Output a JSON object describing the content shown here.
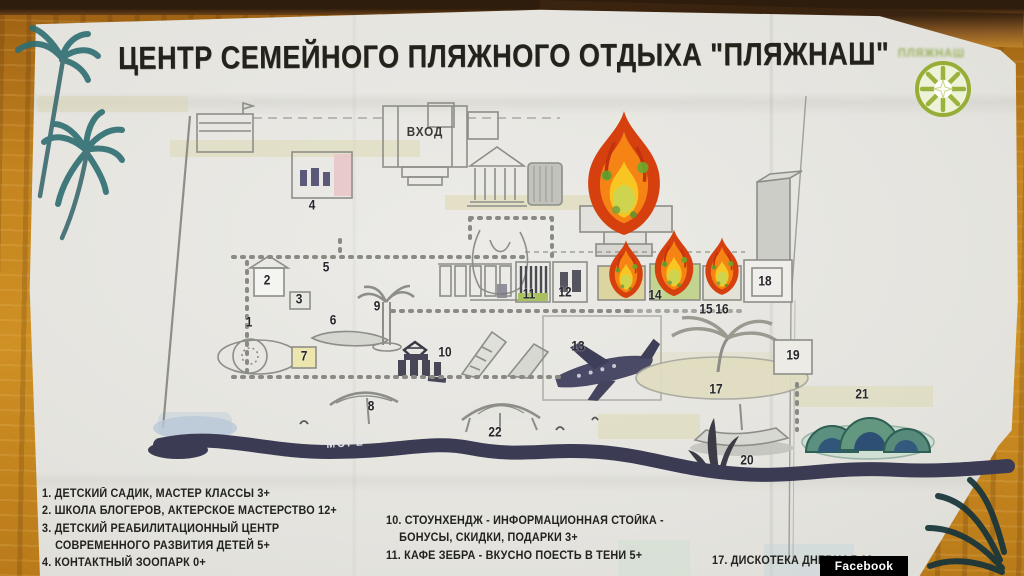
{
  "title": "ЦЕНТР СЕМЕЙНОГО ПЛЯЖНОГО ОТДЫХА \"ПЛЯЖНАШ\"",
  "logo": {
    "text": "ПЛЯЖНАШ"
  },
  "map": {
    "entrance_label": "ВХОД",
    "sea_label": "МОРЕ",
    "markers": [
      {
        "n": "1",
        "x": 249,
        "y": 322
      },
      {
        "n": "2",
        "x": 267,
        "y": 280
      },
      {
        "n": "3",
        "x": 299,
        "y": 299
      },
      {
        "n": "4",
        "x": 312,
        "y": 205
      },
      {
        "n": "5",
        "x": 326,
        "y": 267
      },
      {
        "n": "6",
        "x": 333,
        "y": 320
      },
      {
        "n": "7",
        "x": 304,
        "y": 356
      },
      {
        "n": "8",
        "x": 371,
        "y": 406
      },
      {
        "n": "9",
        "x": 377,
        "y": 306
      },
      {
        "n": "10",
        "x": 445,
        "y": 352
      },
      {
        "n": "11",
        "x": 529,
        "y": 294
      },
      {
        "n": "12",
        "x": 565,
        "y": 292
      },
      {
        "n": "13",
        "x": 578,
        "y": 346
      },
      {
        "n": "14",
        "x": 655,
        "y": 295
      },
      {
        "n": "15",
        "x": 706,
        "y": 309
      },
      {
        "n": "16",
        "x": 722,
        "y": 309
      },
      {
        "n": "17",
        "x": 716,
        "y": 389
      },
      {
        "n": "18",
        "x": 765,
        "y": 281
      },
      {
        "n": "19",
        "x": 793,
        "y": 355
      },
      {
        "n": "20",
        "x": 747,
        "y": 460
      },
      {
        "n": "21",
        "x": 862,
        "y": 394
      },
      {
        "n": "22",
        "x": 495,
        "y": 432
      }
    ]
  },
  "legend": {
    "col1": [
      "1. ДЕТСКИЙ САДИК, МАСТЕР КЛАССЫ 3+",
      "2. ШКОЛА БЛОГЕРОВ, АКТЕРСКОЕ МАСТЕРСТВО 12+",
      "3. ДЕТСКИЙ РЕАБИЛИТАЦИОННЫЙ ЦЕНТР СОВРЕМЕННОГО РАЗВИТИЯ ДЕТЕЙ 5+",
      "4. КОНТАКТНЫЙ ЗООПАРК 0+"
    ],
    "col2": [
      "10. СТОУНХЕНДЖ - ИНФОРМАЦИОННАЯ СТОЙКА - БОНУСЫ, СКИДКИ, ПОДАРКИ 3+",
      "11. КАФЕ ЗЕБРА - ВКУСНО ПОЕСТЬ В ТЕНИ 5+"
    ],
    "col3": [
      "17. ДИСКОТЕКА ДНЕВНАЯ 18+"
    ]
  },
  "watermark": "Facebook",
  "colors": {
    "wood": "#c4841f",
    "paper": "#e6e5e0",
    "map_lines": "#8e8e88",
    "sea_ribbon": "#3b3b54",
    "flame_red": "#d6400e",
    "flame_orange": "#f58414",
    "flame_yellow": "#f8c622",
    "logo_green": "#96ae35"
  }
}
